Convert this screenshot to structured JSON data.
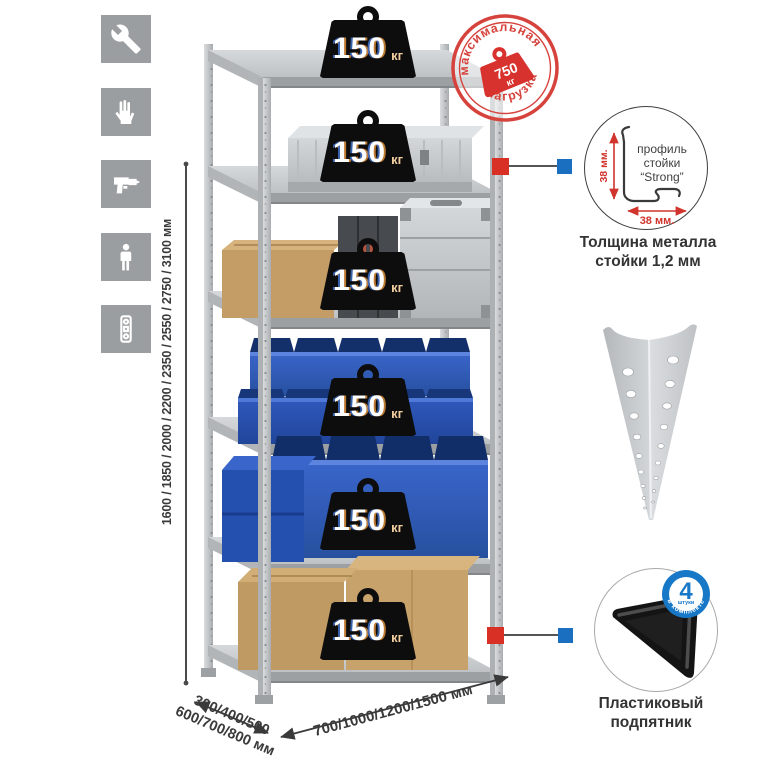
{
  "colors": {
    "accent_red": "#d0342c",
    "stamp_red": "#d6423c",
    "badge_blue": "#1878c8",
    "callout_red": "#d93025",
    "callout_blue": "#1b6fc0",
    "bin_blue": "#2e57b8",
    "cardboard": "#c49d66",
    "metal_gray": "#c6c9cb",
    "icon_bg": "#9b9ea0",
    "weight_black": "#0d0d0d"
  },
  "sidebar": {
    "icons": [
      {
        "name": "wrench-icon"
      },
      {
        "name": "gloves-icon"
      },
      {
        "name": "drill-icon"
      },
      {
        "name": "person-icon"
      },
      {
        "name": "level-icon"
      }
    ]
  },
  "rack": {
    "shelf_count": "6",
    "load_badge": {
      "value": "150",
      "unit": "кг"
    }
  },
  "max_load_stamp": {
    "arc_top": "максимальная",
    "arc_bottom": "нагрузка",
    "value": "750",
    "unit": "кг"
  },
  "dimensions": {
    "height": "1600 / 1850 / 2000 / 2200 / 2350 / 2550 / 2750 / 3100 мм",
    "depth_line1": "300/400/500",
    "depth_line2": "600/700/800 мм",
    "width": "700/1000/1200/1500 мм"
  },
  "profile_callout": {
    "label_line1": "профиль",
    "label_line2": "стойки",
    "label_line3": "“Strong”",
    "dim_vertical": "38 мм.",
    "dim_horizontal": "38 мм.",
    "caption_line1": "Толщина металла",
    "caption_line2": "стойки 1,2 мм"
  },
  "foot_callout": {
    "badge_value": "4",
    "badge_unit": "штуки",
    "badge_ring": "в комплекте",
    "caption_line1": "Пластиковый",
    "caption_line2": "подпятник"
  }
}
